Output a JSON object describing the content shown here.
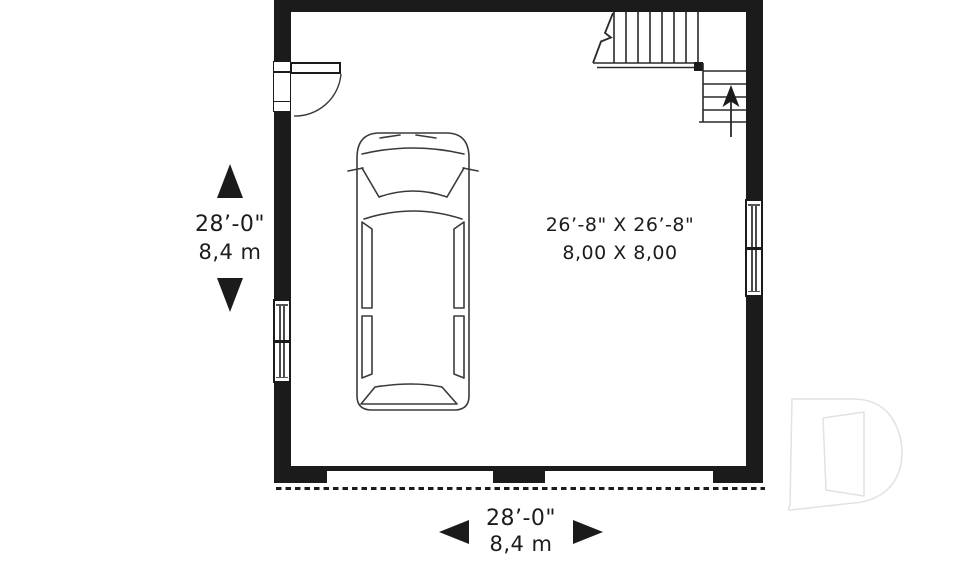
{
  "plan": {
    "room": {
      "size_imperial": "26’-8\" X 26’-8\"",
      "size_metric": "8,00 X 8,00"
    },
    "dimensions": {
      "left": {
        "imperial": "28’-0\"",
        "metric": "8,4 m"
      },
      "bottom": {
        "imperial": "28’-0\"",
        "metric": "8,4 m"
      }
    },
    "colors": {
      "wall": "#1b1b1b",
      "drawing_line": "#3a3a3a",
      "watermark": "#e2e2e2",
      "background": "#ffffff"
    },
    "icons": [
      "up-arrow-icon",
      "down-arrow-icon",
      "left-arrow-icon",
      "right-arrow-icon",
      "stair-up-arrow-icon",
      "car-top-view",
      "entry-door-swing",
      "drummond-d-logo"
    ]
  }
}
